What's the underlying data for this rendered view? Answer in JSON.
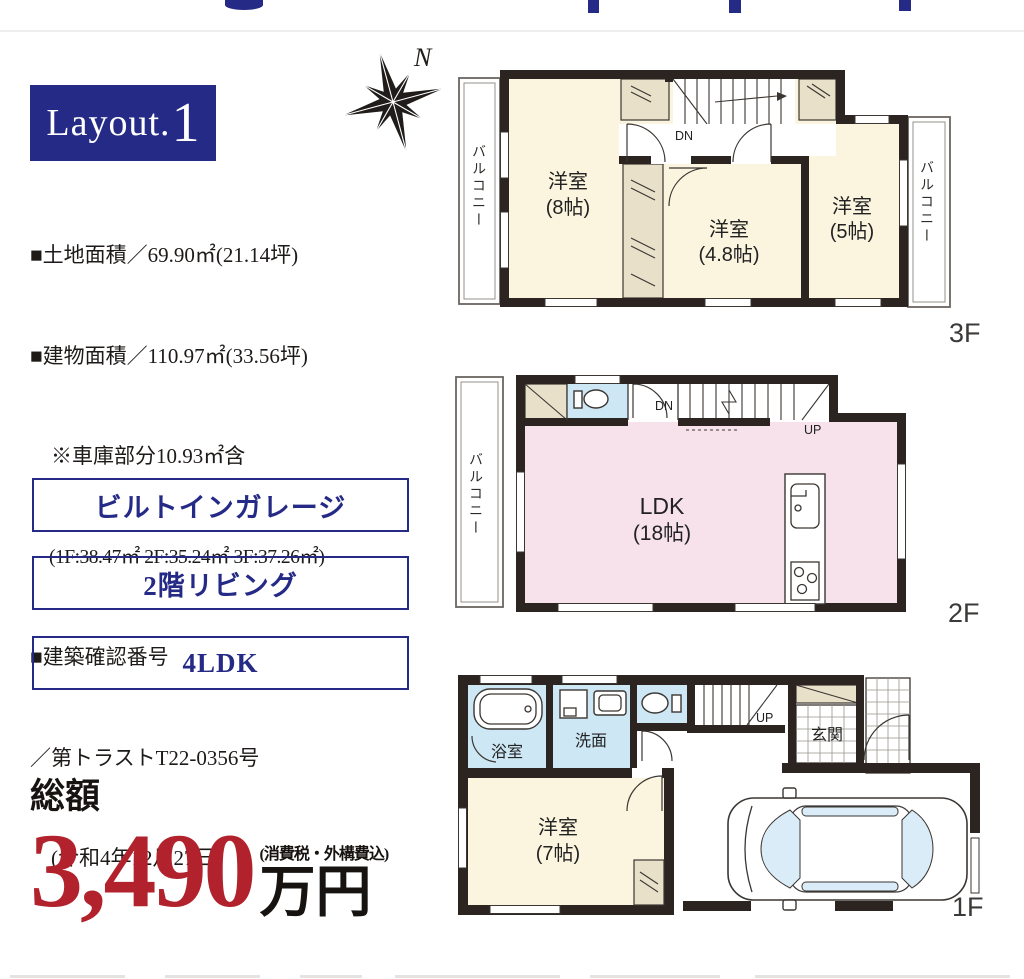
{
  "colors": {
    "navy": "#242a86",
    "red": "#b2222c",
    "ink": "#1f1c1a",
    "wall": "#2b2421",
    "cream": "#fbf5df",
    "pink": "#f7e2ec",
    "aqua": "#cde7f5",
    "beige": "#e8e0c9",
    "glass": "#d9ecf7"
  },
  "badge": {
    "prefix": "Layout.",
    "number": "1"
  },
  "compass": {
    "label": "N"
  },
  "property": {
    "lines": [
      "■土地面積／69.90㎡(21.14坪)",
      "■建物面積／110.97㎡(33.56坪)",
      "　※車庫部分10.93㎡含",
      "　(1F:38.47㎡ 2F:35.24㎡ 3F:37.26㎡)",
      "■建築確認番号",
      "／第トラストT22-0356号",
      "　(令和4年12月27日)"
    ]
  },
  "features": {
    "box1": "ビルトインガレージ",
    "box2": "2階リビング",
    "box3": "4LDK"
  },
  "price": {
    "prefix": "総額",
    "amount": "3,490",
    "note": "(消費税・外構費込)",
    "unit": "万円"
  },
  "floor3": {
    "label": "3F",
    "balcony_left": "バルコニー",
    "balcony_right": "バルコニー",
    "stairs_down": "DN",
    "room1_name": "洋室",
    "room1_size": "(8帖)",
    "room2_name": "洋室",
    "room2_size": "(4.8帖)",
    "room3_name": "洋室",
    "room3_size": "(5帖)"
  },
  "floor2": {
    "label": "2F",
    "balcony_left": "バルコニー",
    "stairs_down": "DN",
    "stairs_up": "UP",
    "room_name": "LDK",
    "room_size": "(18帖)"
  },
  "floor1": {
    "label": "1F",
    "bath": "浴室",
    "wash": "洗面",
    "entrance": "玄関",
    "stairs_up": "UP",
    "room_name": "洋室",
    "room_size": "(7帖)"
  }
}
